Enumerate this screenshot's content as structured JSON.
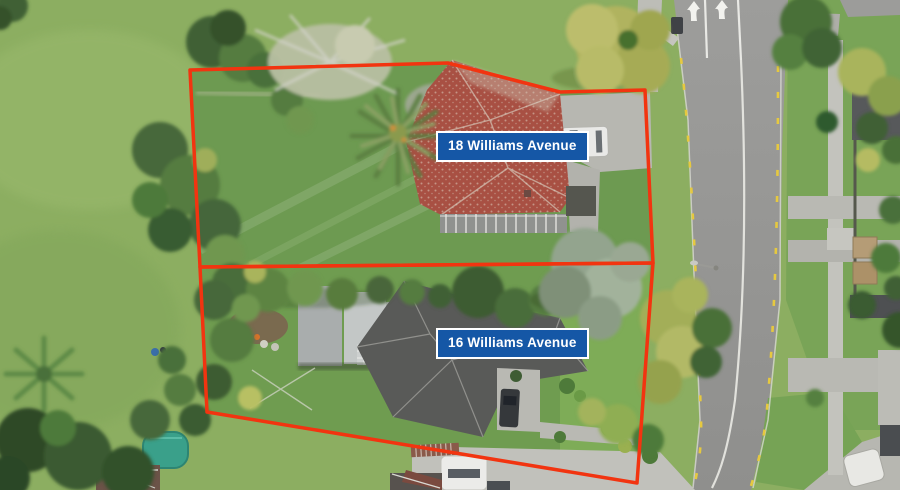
{
  "annotations": {
    "property_18_label": "18 Williams Avenue",
    "property_16_label": "16 Williams Avenue"
  },
  "colors": {
    "boundary_red": "#f23410",
    "label_blue": "#1557a6",
    "label_border": "#ffffff",
    "label_text": "#ffffff"
  }
}
